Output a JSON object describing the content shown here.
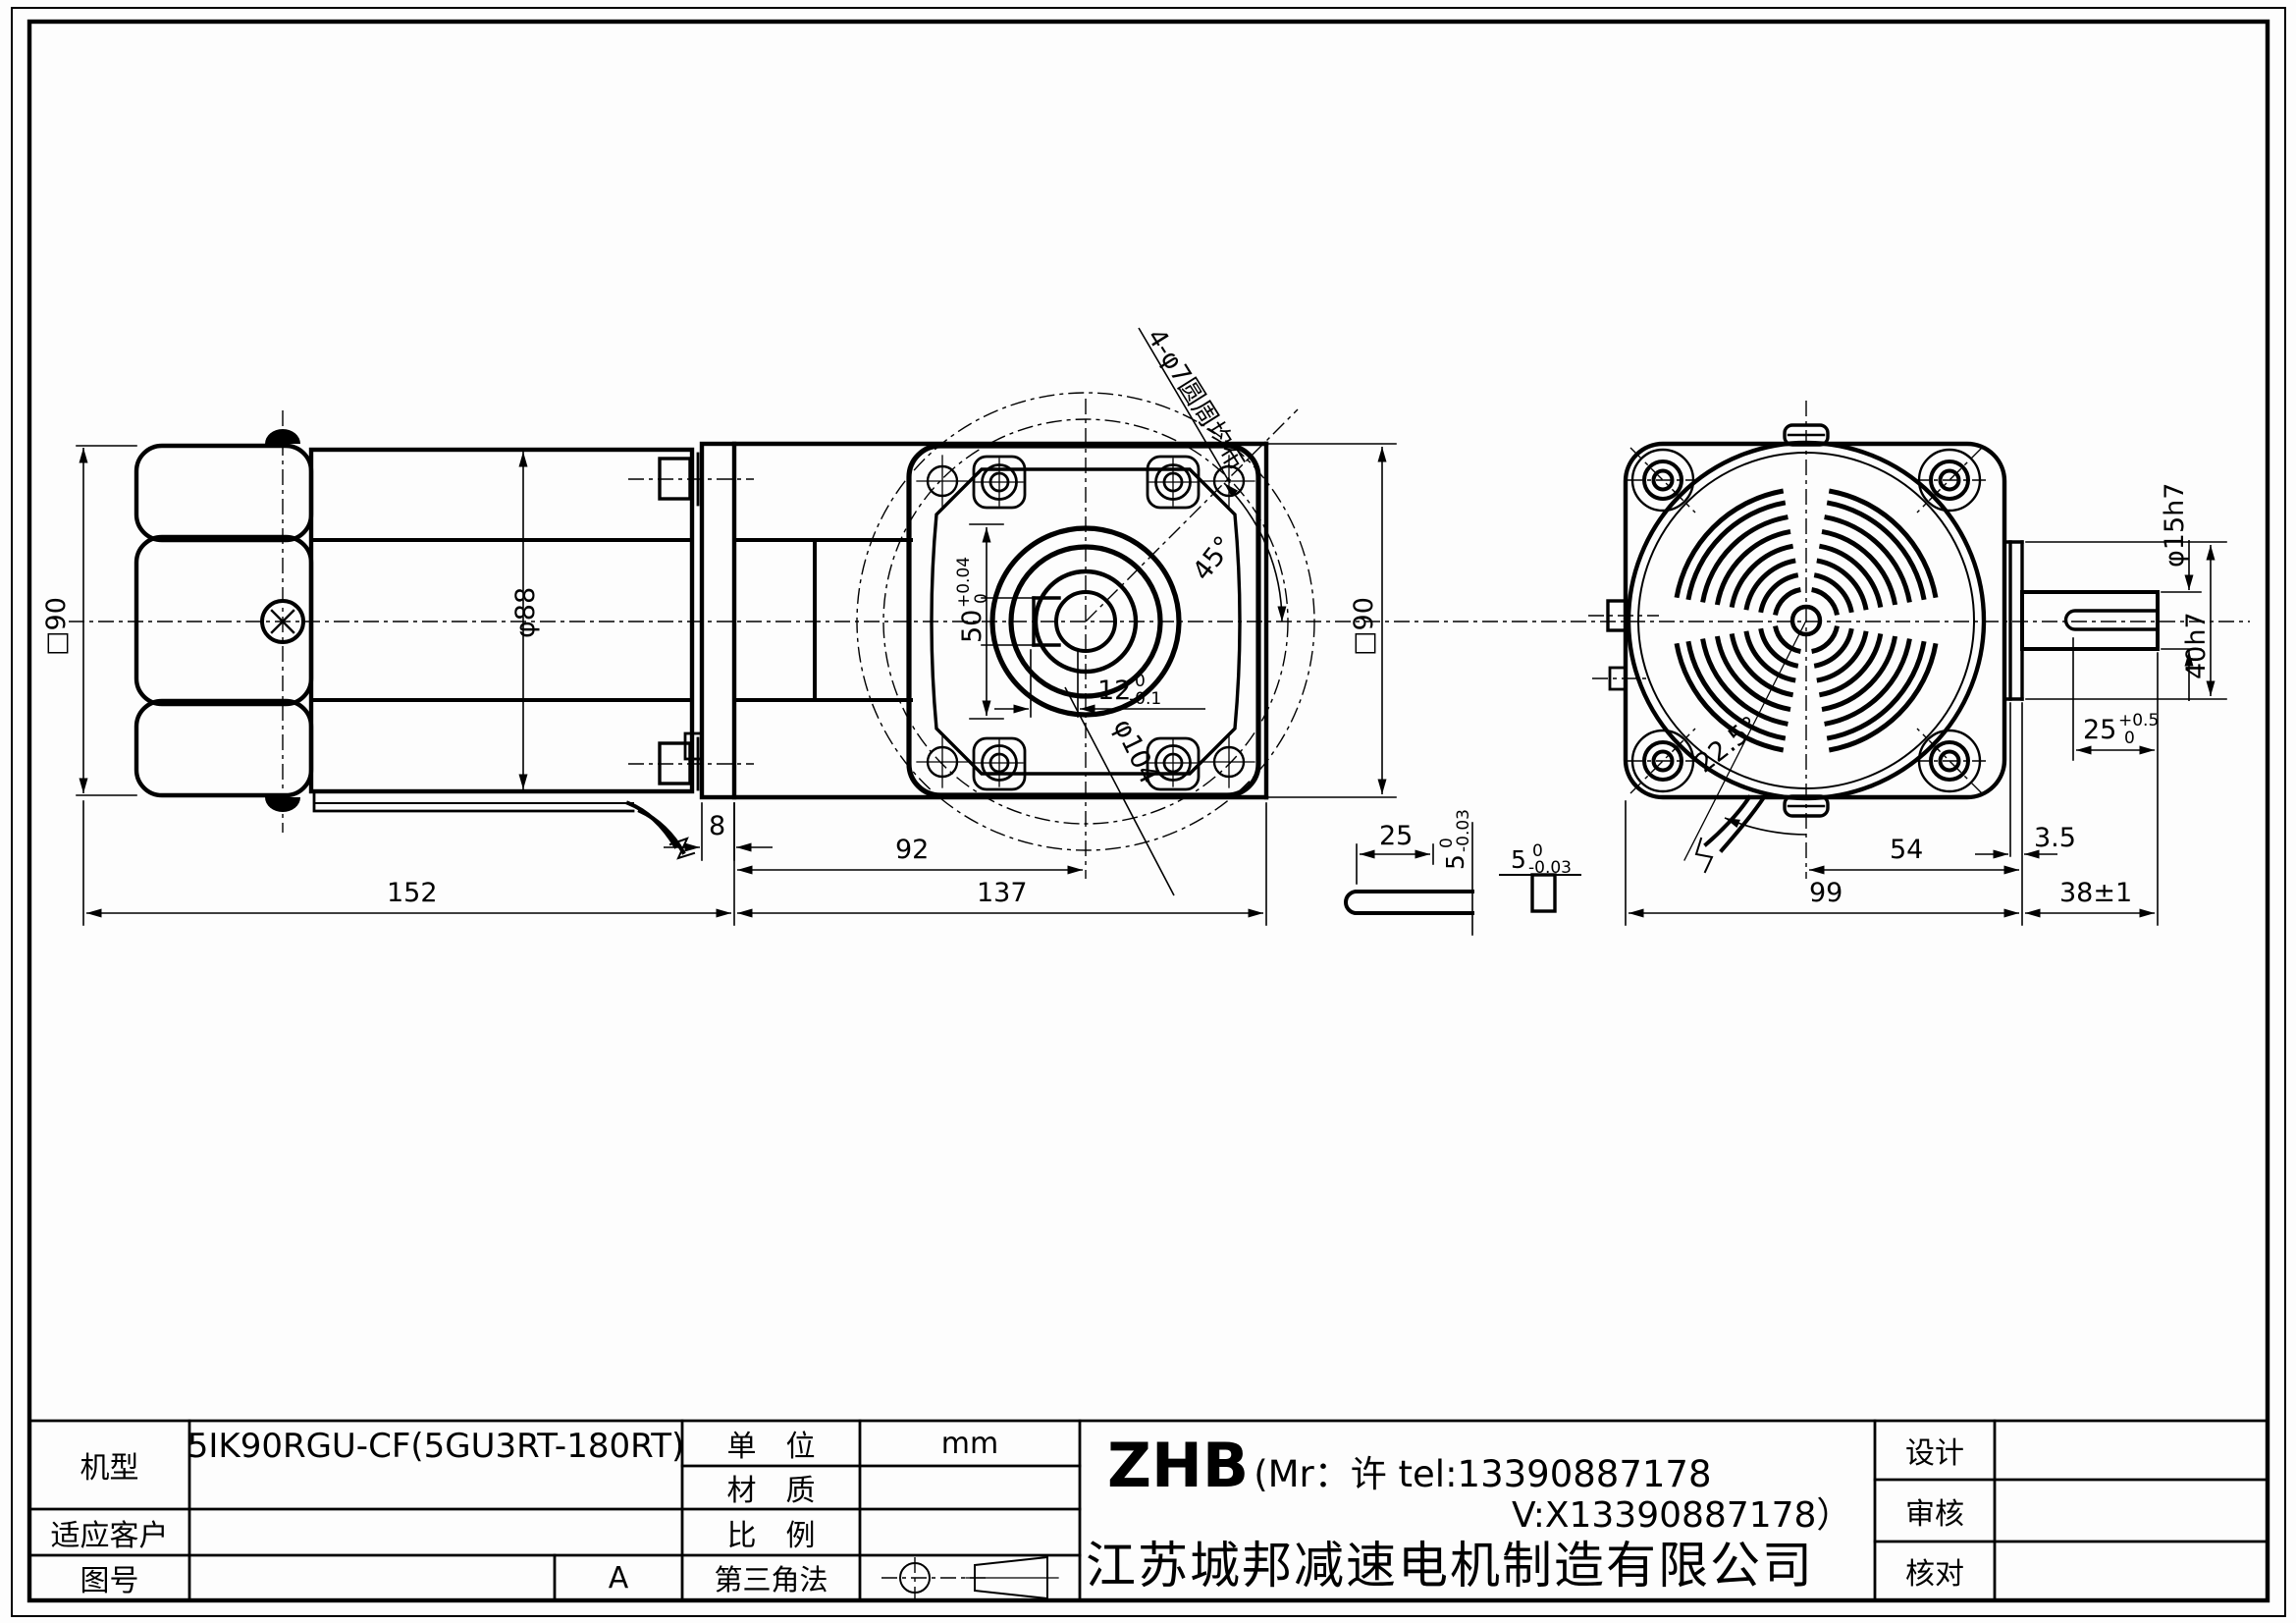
{
  "title_block": {
    "model_label": "机型",
    "model_value": "5IK90RGU-CF(5GU3RT-180RT)",
    "customer_label": "适应客户",
    "customer_value": "",
    "drawing_no_label": "图号",
    "drawing_no_value": "",
    "revision": "A",
    "unit_label": "单　位",
    "unit_value": "mm",
    "material_label": "材　质",
    "material_value": "",
    "scale_label": "比　例",
    "scale_value": "",
    "projection_label": "第三角法",
    "company_brand": "ZHB",
    "company_contact": "(Mr：许 tel:13390887178",
    "company_contact2": "V:X13390887178）",
    "company_name": "江苏城邦减速电机制造有限公司",
    "design_label": "设计",
    "design_value": "",
    "review_label": "审核",
    "review_value": "",
    "check_label": "核对",
    "check_value": ""
  },
  "dims": {
    "side_view": {
      "square90": "□90",
      "motor_dia": "φ88",
      "flange_thickness": "8",
      "gear_len": "92",
      "motor_len": "152",
      "gearbox_len": "137"
    },
    "front_view": {
      "boss": "50",
      "boss_tol_up": "+0.04",
      "boss_tol_dn": "0",
      "key_width": "12",
      "key_tol_up": "0",
      "key_tol_dn": "-0.1",
      "bolt_circle": "φ104",
      "angle": "45°",
      "holes_note": "4-φ7圆周均布",
      "square90": "□90"
    },
    "rear_view": {
      "angle": "22.5°",
      "len54": "54",
      "len99": "99",
      "len38": "38±1",
      "plate": "3.5",
      "shaft_dia": "φ15h7",
      "boss_dia": "40h7",
      "key_len": "25",
      "key_len_tol_up": "+0.5",
      "key_len_tol_dn": "0"
    },
    "key_detail": {
      "len": "25",
      "height": "5",
      "height_tol_up": "0",
      "height_tol_dn": "-0.03",
      "width": "5",
      "width_tol_up": "0",
      "width_tol_dn": "-0.03"
    }
  }
}
